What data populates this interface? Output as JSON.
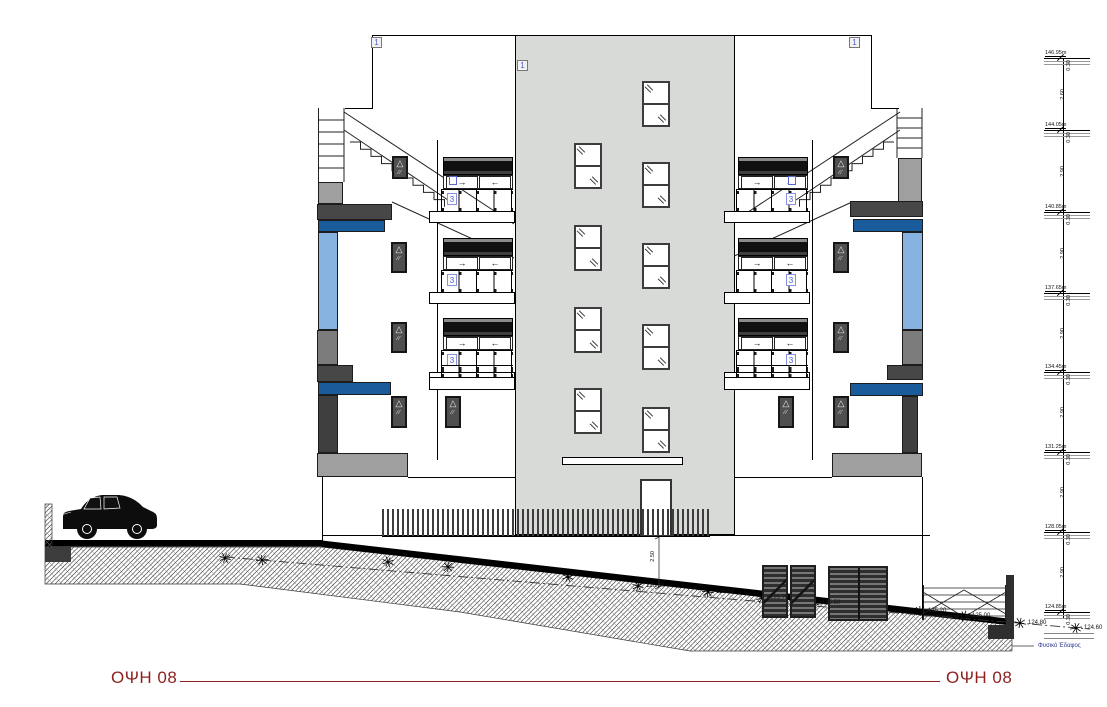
{
  "drawing": {
    "title_left": "ΟΨΗ 08",
    "title_right": "ΟΨΗ 08"
  },
  "markers": {
    "roof": "1",
    "tower": "1",
    "balcony": "3"
  },
  "balcony": {
    "left_door_arrow": "→",
    "right_door_arrow": "←"
  },
  "dimension_chain": {
    "levels": [
      "146.95m",
      "144.05m",
      "140.85m",
      "137.65m",
      "134.45m",
      "131.25m",
      "128.05m",
      "124.85m"
    ],
    "slab_thickness": "0.30",
    "gaps": [
      "2.60",
      "2.90",
      "2.90",
      "2.90",
      "2.90",
      "2.90",
      "2.90"
    ]
  },
  "ground": {
    "spot_levels": [
      "126.20",
      "126.00",
      "125.70",
      "125.50",
      "125.20",
      "125.00",
      "124.80",
      "124.60"
    ],
    "natural_ground_label": "Φυσικό Έδαφος",
    "ramp_height_dim": "2.50"
  },
  "colors": {
    "accent_red": "#8e1f1f",
    "glass_blue": "#87b3e1",
    "band_blue": "#1a5b9b",
    "marker_blue": "#4d5fd0",
    "tower_grey": "#d8dad7"
  }
}
